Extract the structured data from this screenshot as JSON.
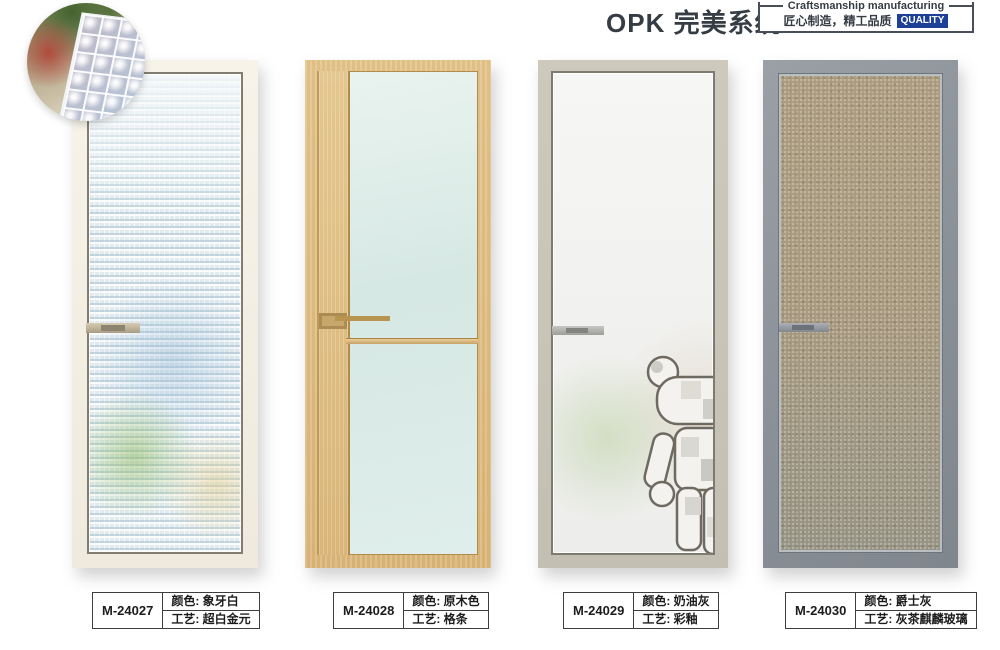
{
  "header": {
    "title": "OPK 完美系统",
    "badge": {
      "line1_en": "Craftsmanship manufacturing",
      "line2_cn": "匠心制造，精工品质",
      "quality": "QUALITY",
      "quality_bg": "#1d3f96"
    }
  },
  "detail_inset": {
    "description": "diamond-pattern glass texture close-up"
  },
  "labels": {
    "color": "颜色:",
    "craft": "工艺:"
  },
  "products": [
    {
      "model": "M-24027",
      "color": "象牙白",
      "craft": "超白金元",
      "frame_color": "#f3eee2",
      "glass_color": "#d9e5ea"
    },
    {
      "model": "M-24028",
      "color": "原木色",
      "craft": "格条",
      "frame_color": "#dcba7e",
      "glass_color": "#dcebe7"
    },
    {
      "model": "M-24029",
      "color": "奶油灰",
      "craft": "彩釉",
      "frame_color": "#c8c4b8",
      "glass_color": "#f2f2f0"
    },
    {
      "model": "M-24030",
      "color": "爵士灰",
      "craft": "灰茶麒麟玻璃",
      "frame_color": "#8b9097",
      "glass_color": "#a2957a"
    }
  ]
}
